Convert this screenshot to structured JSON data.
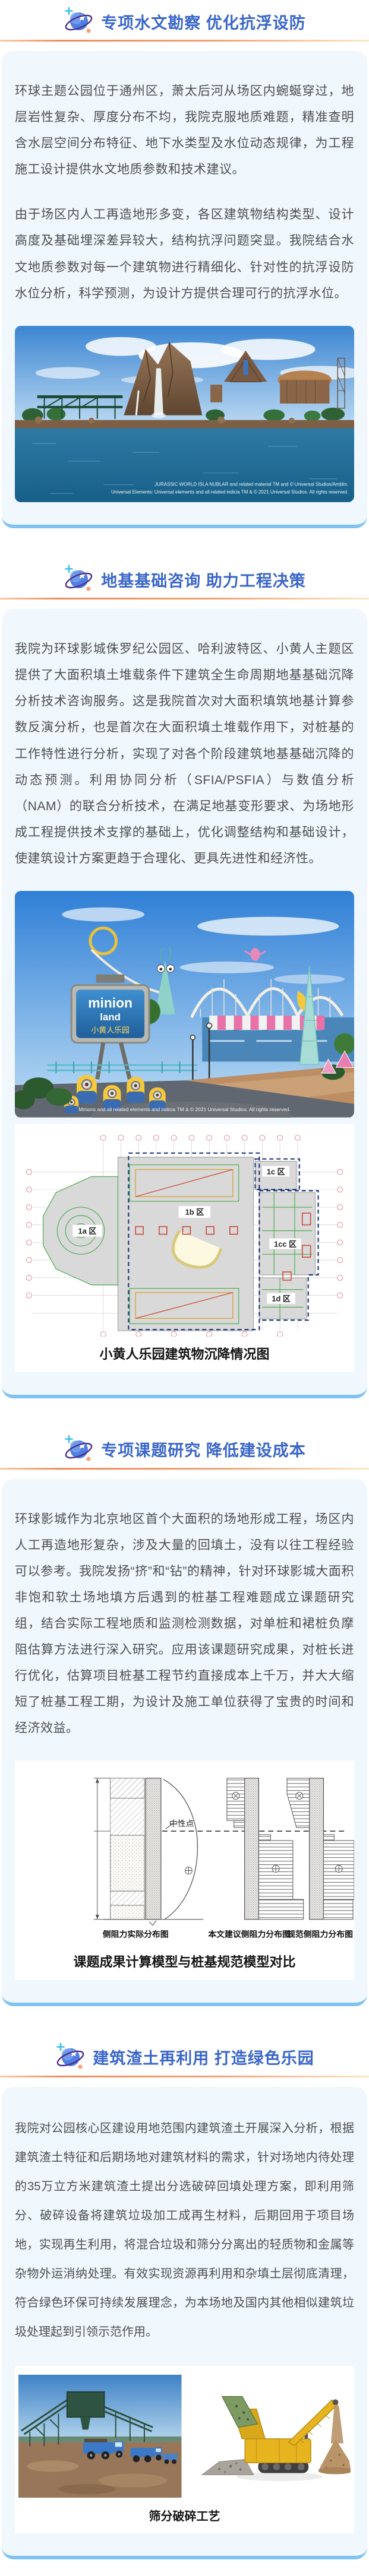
{
  "theme": {
    "title_color": "#3a66c9",
    "card_background": "#f0f7fd",
    "card_bottom_border": "#7ec3f3",
    "divider_orange": "#ee8d59",
    "body_text_color": "#4e4e4e"
  },
  "sections": [
    {
      "id": "hydrology",
      "title": "专项水文勘察 优化抗浮设防",
      "paragraphs": [
        "环球主题公园位于通州区，萧太后河从场区内蜿蜒穿过，地层岩性复杂、厚度分布不均，我院克服地质难题，精准查明含水层空间分布特征、地下水类型及水位动态规律，为工程施工设计提供水文地质参数和技术建议。",
        "由于场区内人工再造地形多变，各区建筑物结构类型、设计高度及基础埋深差异较大，结构抗浮问题突显。我院结合水文地质参数对每一个建筑物进行精细化、针对性的抗浮设防水位分析，科学预测，为设计方提供合理可行的抗浮水位。"
      ],
      "image": {
        "watermark_line1": "JURASSIC WORLD ISLA NUBLAR and related material TM and © Universal Studios/Amblin.",
        "watermark_line2": "Universal Elements: Universal elements and all related indicia TM & © 2021 Universal Studios. All rights reserved."
      }
    },
    {
      "id": "foundation-consulting",
      "title": "地基基础咨询 助力工程决策",
      "paragraphs": [
        "我院为环球影城侏罗纪公园区、哈利波特区、小黄人主题区提供了大面积填土堆载条件下建筑全生命周期地基基础沉降分析技术咨询服务。这是我院首次对大面积填筑地基计算参数反演分析，也是首次在大面积填土堆载作用下，对桩基的工作特性进行分析，实现了对各个阶段建筑地基基础沉降的动态预测。利用协同分析（SFIA/PSFIA）与数值分析（NAM）的联合分析技术，在满足地基变形要求、为场地形成工程提供技术支撑的基础上，优化调整结构和基础设计，使建筑设计方案更趋于合理化、更具先进性和经济性。"
      ],
      "photo": {
        "sign_line1": "minion",
        "sign_line2": "land",
        "sign_line3": "小黄人乐园",
        "watermark": "Minions and all related elements and indicia TM & © 2021 Universal Studios. All rights reserved."
      },
      "plan": {
        "labels": [
          "1a 区",
          "1b 区",
          "1c 区",
          "1cc 区",
          "1d 区"
        ],
        "caption": "小黄人乐园建筑物沉降情况图"
      }
    },
    {
      "id": "special-research",
      "title": "专项课题研究 降低建设成本",
      "paragraphs": [
        "环球影城作为北京地区首个大面积的场地形成工程，场区内人工再造地形复杂，涉及大量的回填土，没有以往工程经验可以参考。我院发扬“挤”和“钻”的精神，针对环球影城大面积非饱和软土场地填方后遇到的桩基工程难题成立课题研究组，结合实际工程地质和监测检测数据，对单桩和裙桩负摩阻估算方法进行深入研究。应用该课题研究成果，对桩长进行优化，估算项目桩基工程节约直接成本上千万，并大大缩短了桩基工程工期，为设计及施工单位获得了宝贵的时间和经济效益。"
      ],
      "diagram": {
        "neutral_point_label": "中性点",
        "sub_captions": [
          "侧阻力实际分布图",
          "本文建议侧阻力分布图",
          "规范侧阻力分布图"
        ],
        "caption": "课题成果计算模型与桩基规范模型对比"
      }
    },
    {
      "id": "recycling",
      "title": "建筑渣土再利用 打造绿色乐园",
      "paragraphs": [
        "我院对公园核心区建设用地范围内建筑渣土开展深入分析，根据建筑渣土特征和后期场地对建筑材料的需求，针对场地内待处理的35万立方米建筑渣土提出分选破碎回填处理方案，即利用筛分、破碎设备将建筑垃圾加工成再生材料，后期回用于项目场地，实现再生利用，将混合垃圾和筛分分离出的轻质物和金属等杂物外运消纳处理。有效实现资源再利用和杂填土层彻底清理，符合绿色环保可持续发展理念，为本场地及国内其他相似建筑垃圾处理起到引领示范作用。"
      ],
      "figure_caption": "筛分破碎工艺"
    }
  ]
}
